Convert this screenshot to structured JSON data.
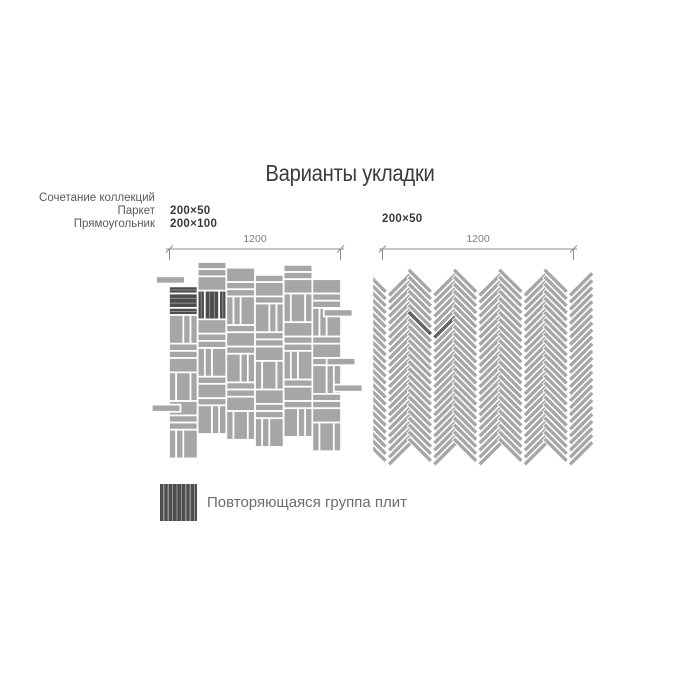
{
  "title": "Варианты укладки",
  "note": {
    "line1": "Сочетание коллекций",
    "line2": "Паркет",
    "line3": "Прямоугольник"
  },
  "sizes_left": {
    "size1": "200×50",
    "size2": "200×100"
  },
  "size_right": "200×50",
  "dimension_left": "1200",
  "dimension_right": "1200",
  "legend_label": "Повторяющаяся группа плит",
  "patterns": {
    "left_type": "mixed-basketweave",
    "right_type": "herringbone-45",
    "highlight_meaning": "repeating tile group"
  },
  "colors": {
    "tile": "#a6a6a6",
    "tile_dark": "#4d4d4d",
    "grain": "#909090",
    "gap": "#ffffff",
    "dim_line": "#8c8c8c",
    "dim_text": "#7d7d7d",
    "title_text": "#3b3b3b",
    "note_text": "#595a5c",
    "size_text": "#3a3a3c",
    "legend_text": "#6c6c6c"
  }
}
